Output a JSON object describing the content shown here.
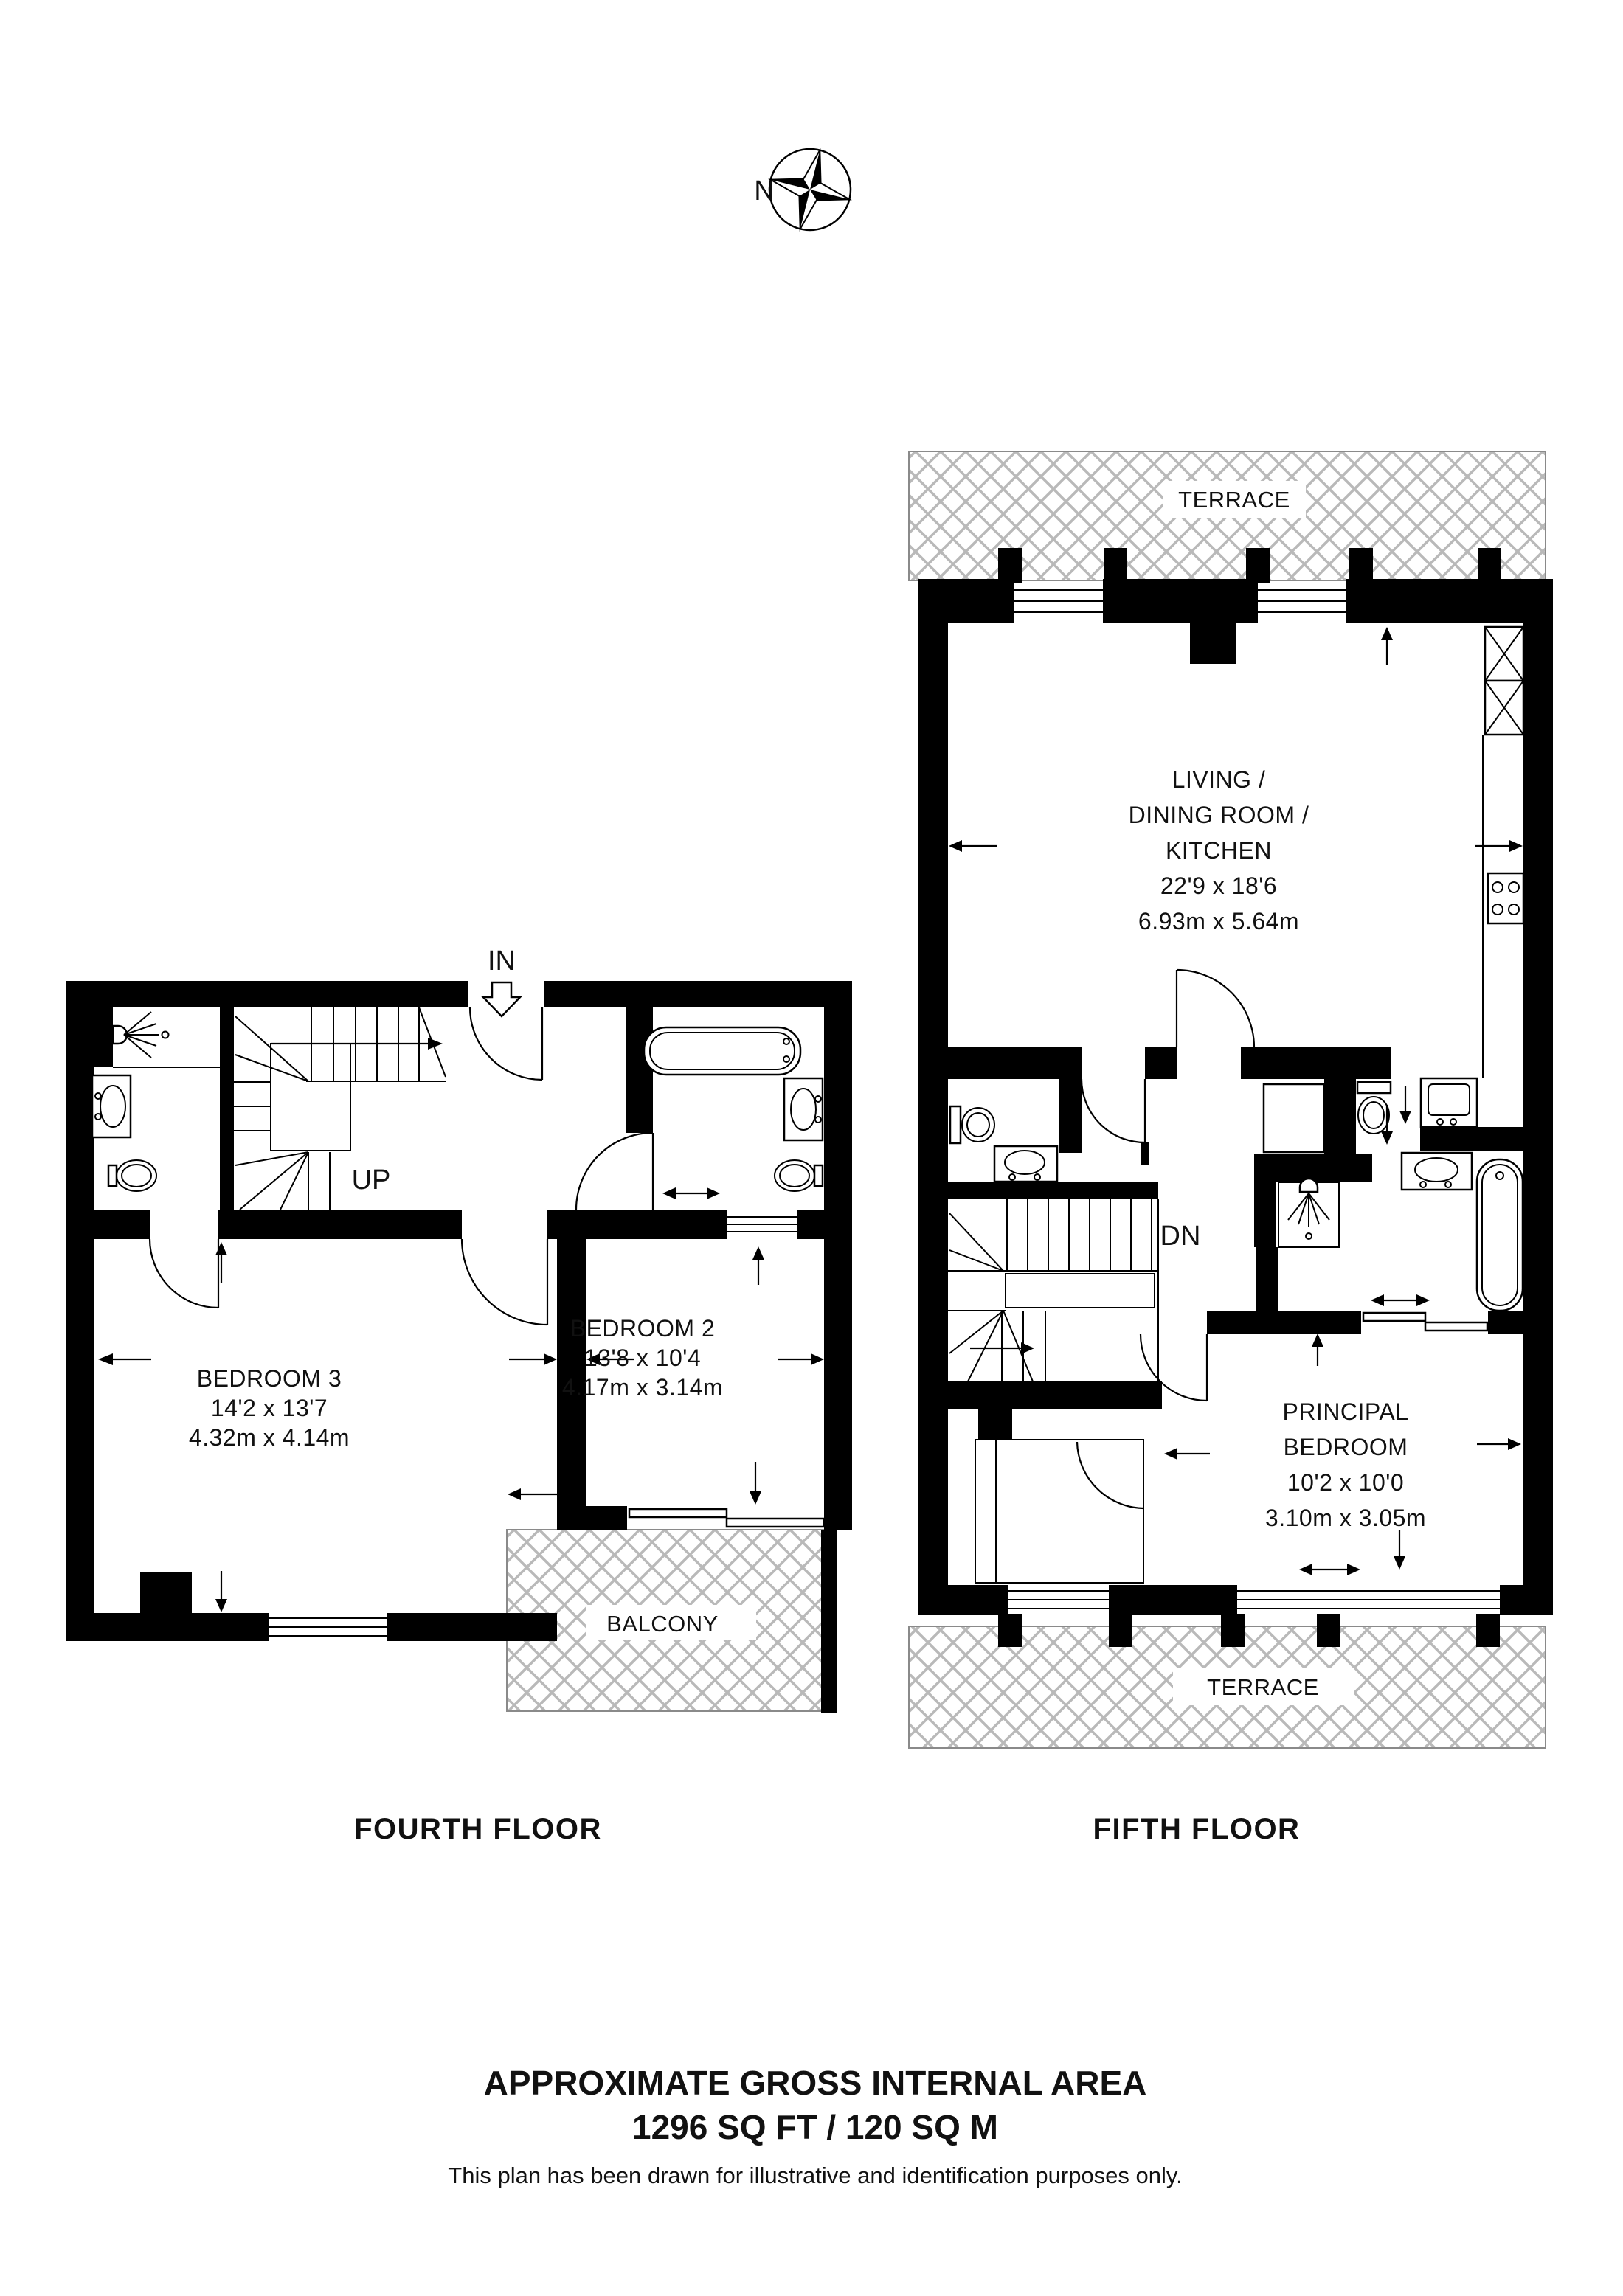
{
  "compass": {
    "label": "N"
  },
  "fourth": {
    "title": "FOURTH FLOOR",
    "in_label": "IN",
    "up_label": "UP",
    "bedroom3": {
      "name": "BEDROOM 3",
      "imperial": "14'2 x 13'7",
      "metric": "4.32m x 4.14m"
    },
    "bedroom2": {
      "name": "BEDROOM 2",
      "imperial": "13'8 x 10'4",
      "metric": "4.17m x 3.14m"
    },
    "balcony": {
      "name": "BALCONY"
    }
  },
  "fifth": {
    "title": "FIFTH FLOOR",
    "dn_label": "DN",
    "living": {
      "line1": "LIVING /",
      "line2": "DINING ROOM /",
      "line3": "KITCHEN",
      "imperial": "22'9 x 18'6",
      "metric": "6.93m x 5.64m"
    },
    "principal": {
      "line1": "PRINCIPAL",
      "line2": "BEDROOM",
      "imperial": "10'2 x 10'0",
      "metric": "3.10m x 3.05m"
    },
    "terrace_top": {
      "name": "TERRACE"
    },
    "terrace_bottom": {
      "name": "TERRACE"
    }
  },
  "footer": {
    "area_title": "APPROXIMATE GROSS INTERNAL AREA",
    "area_value": "1296 SQ FT / 120 SQ M",
    "disclaimer": "This plan has been drawn for illustrative and identification purposes only."
  },
  "colors": {
    "wall": "#000000",
    "hatch": "#b9b9b9",
    "background": "#ffffff"
  }
}
